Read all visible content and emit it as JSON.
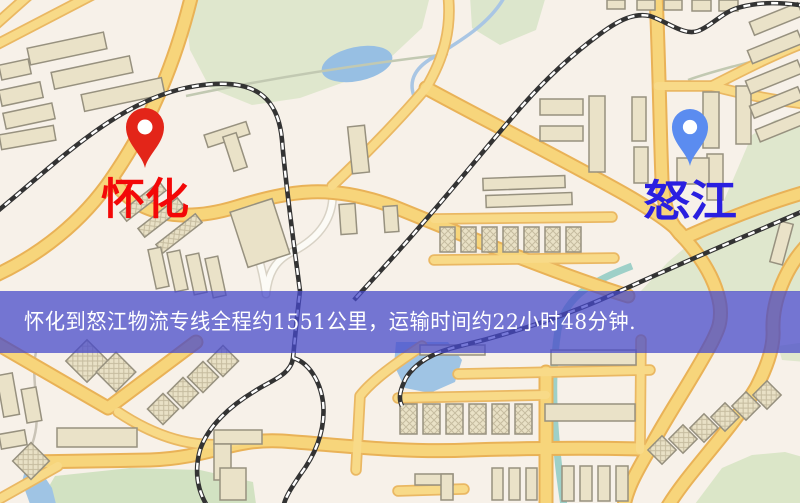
{
  "banner": {
    "text": "怀化到怒江物流专线全程约1551公里，运输时间约22小时48分钟.",
    "bg_color": "#4649cb",
    "text_color": "#ffffff"
  },
  "origin": {
    "label": "怀化",
    "pin_color": "#e32519",
    "label_color": "#f30808"
  },
  "destination": {
    "label": "怒江",
    "pin_color": "#5b8cf0",
    "label_color": "#2a1fe0"
  },
  "icons": {
    "origin_pin": "map-pin",
    "destination_pin": "map-pin"
  },
  "palette": {
    "background": "#f7f1e9",
    "park": "#dfe7cd",
    "water": "#97bfe3",
    "road_major": "#f7d57b",
    "road_casing": "#e9b257",
    "building": "#eae2c8",
    "railway": "#333333"
  }
}
